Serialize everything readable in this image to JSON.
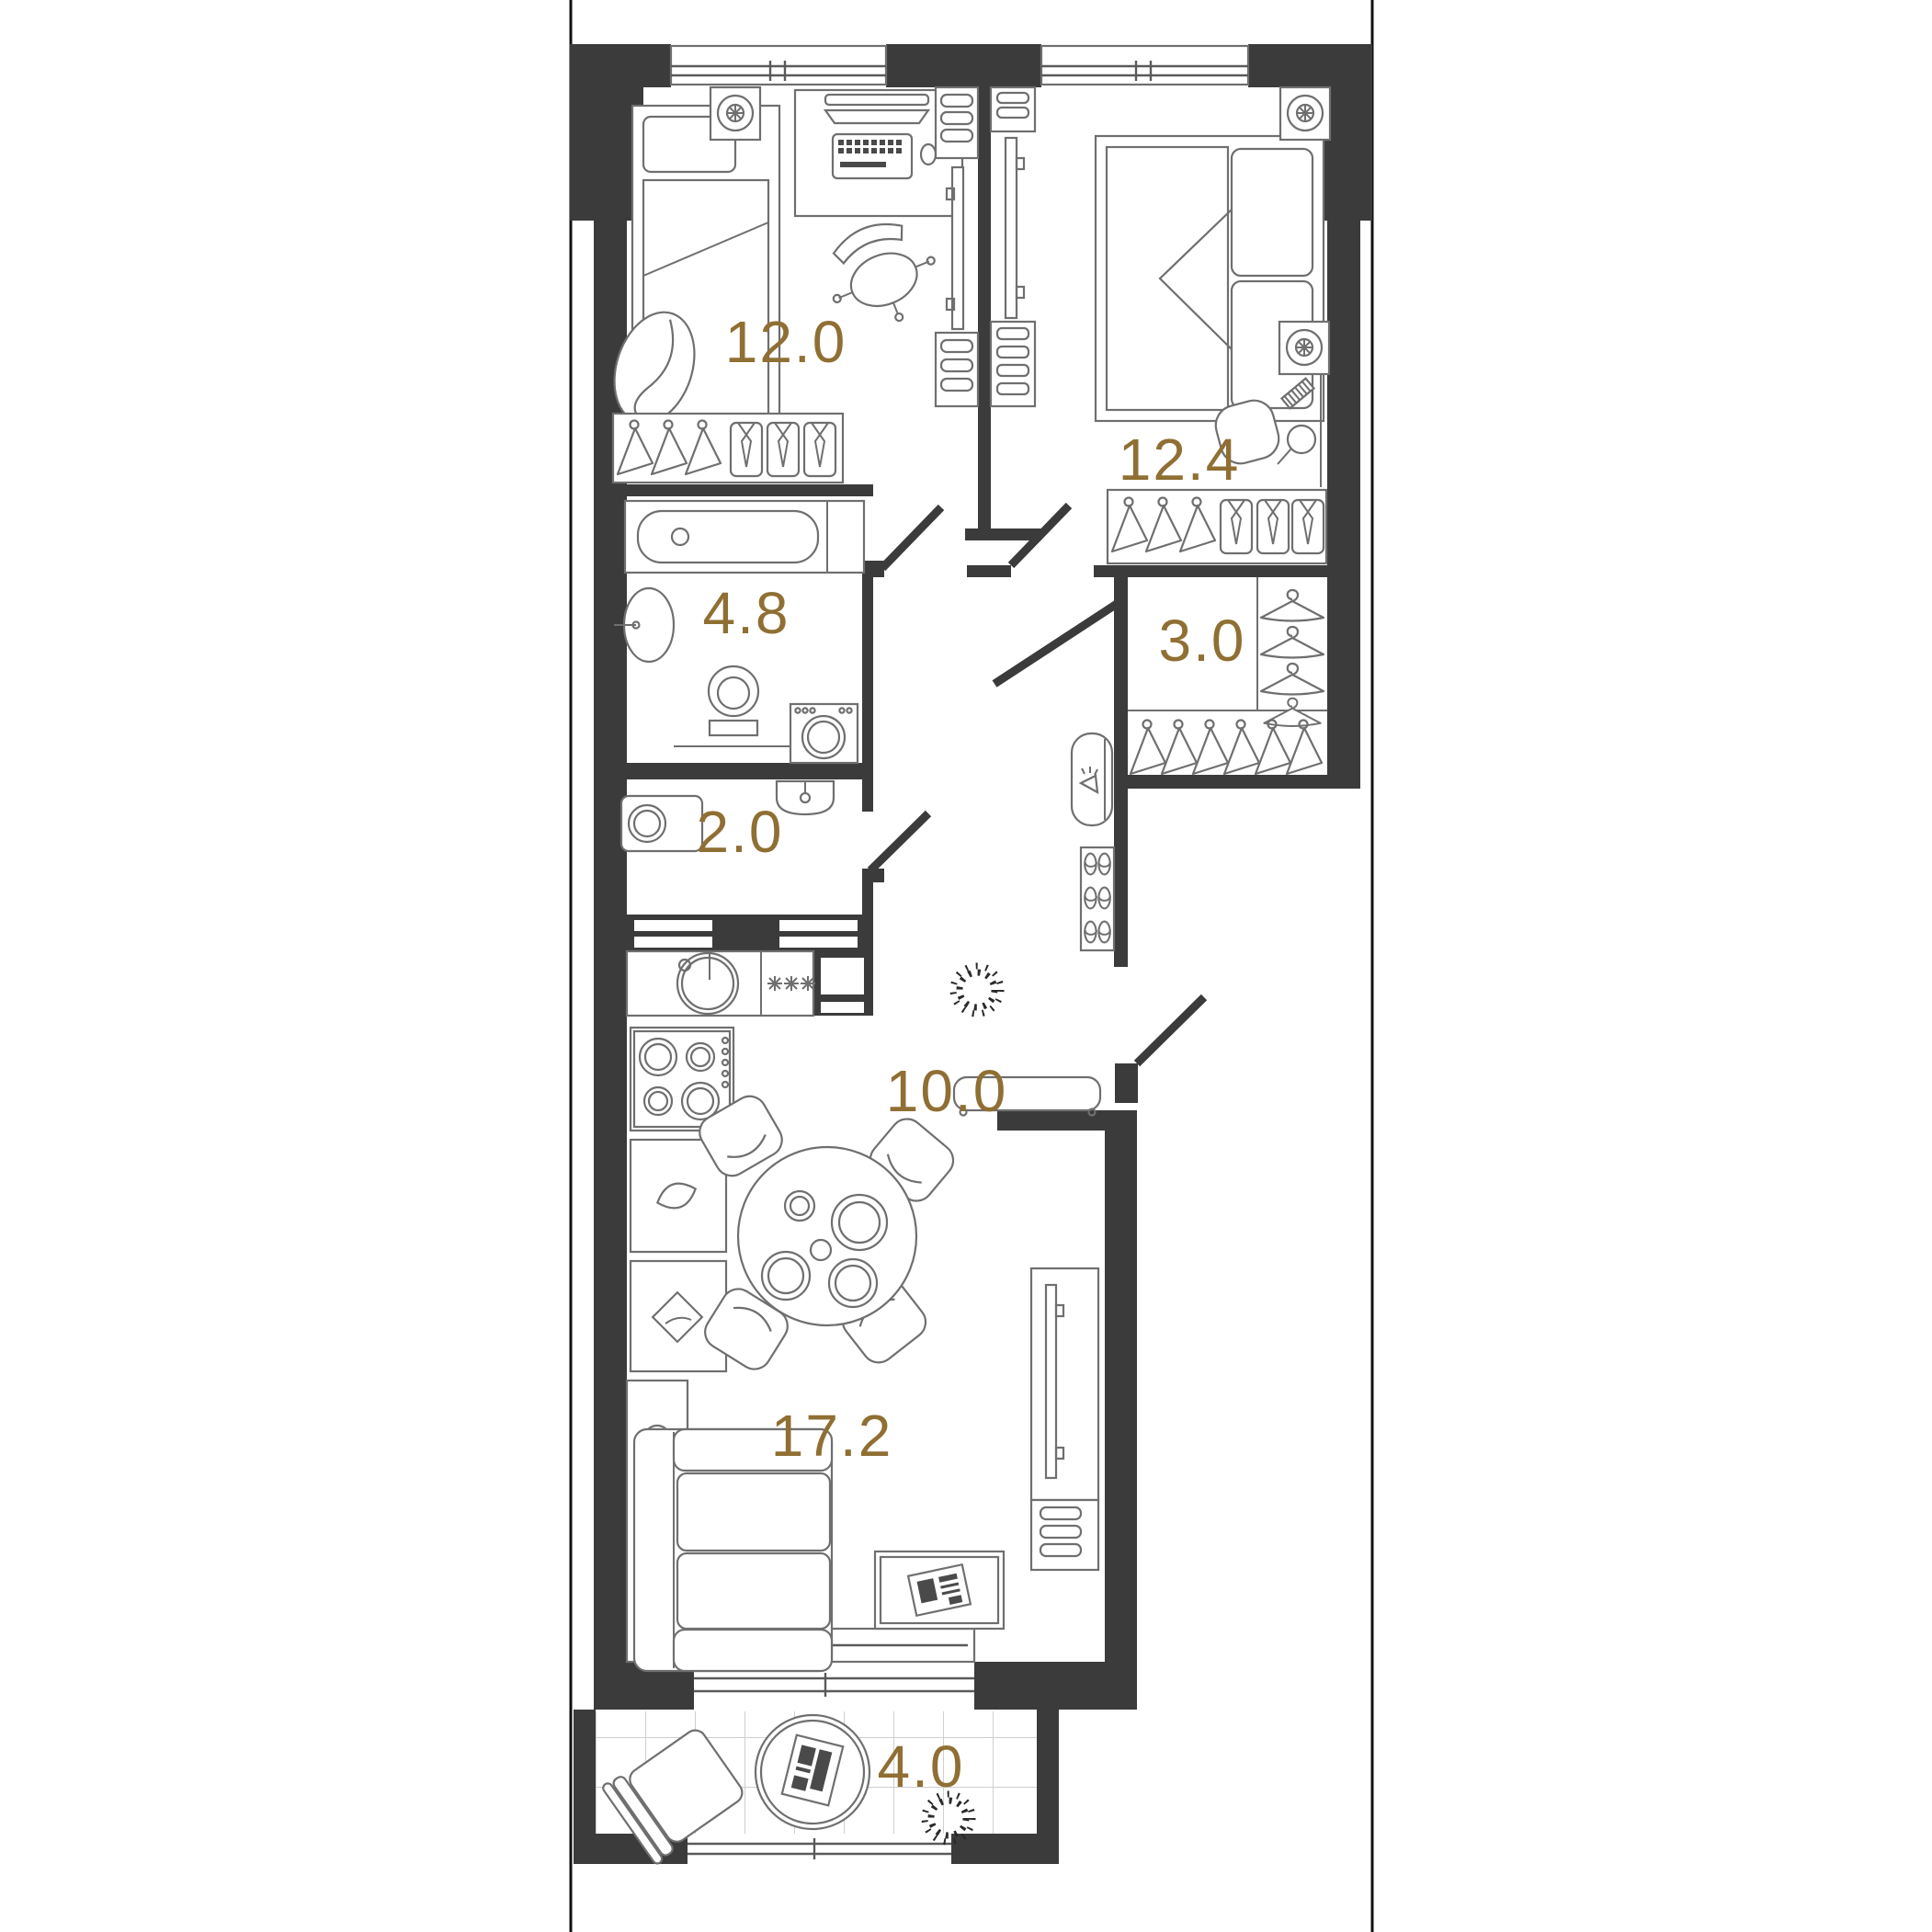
{
  "plan": {
    "type": "apartment-floor-plan",
    "units": "m2",
    "wall_color": "#3b3b3b",
    "label_color": "#8f6f33",
    "background": "#ffffff"
  },
  "rooms": [
    {
      "id": "bedroom-1",
      "area_label": "12.0",
      "fixtures": [
        "single-bed",
        "desk",
        "office-chair",
        "armchair",
        "wardrobe-hangers-shirts",
        "tv-panel",
        "shelves",
        "vent"
      ]
    },
    {
      "id": "bedroom-2",
      "area_label": "12.4",
      "fixtures": [
        "double-bed",
        "pillows",
        "vanity-stool",
        "comb",
        "hand-mirror",
        "wardrobe-hangers-shirts",
        "tv-panel",
        "shelves",
        "vent"
      ]
    },
    {
      "id": "bathroom",
      "area_label": "4.8",
      "fixtures": [
        "bathtub",
        "sink",
        "toilet",
        "washing-machine"
      ]
    },
    {
      "id": "walk-in-closet",
      "area_label": "3.0",
      "fixtures": [
        "hangers-front",
        "hangers-side"
      ]
    },
    {
      "id": "wc",
      "area_label": "2.0",
      "fixtures": [
        "washing-machine",
        "sink"
      ]
    },
    {
      "id": "hallway",
      "area_label": "10.0",
      "fixtures": [
        "mirror-with-light",
        "shoe-rack",
        "bench",
        "plant"
      ]
    },
    {
      "id": "kitchen-living",
      "area_label": "17.2",
      "fixtures": [
        "kitchen-sink",
        "fridge",
        "hob",
        "cabinets",
        "dining-table",
        "chairs",
        "sofa",
        "coffee-table",
        "tv-stand"
      ]
    },
    {
      "id": "balcony",
      "area_label": "4.0",
      "fixtures": [
        "tiled-floor",
        "chair",
        "round-table",
        "plant"
      ]
    }
  ]
}
